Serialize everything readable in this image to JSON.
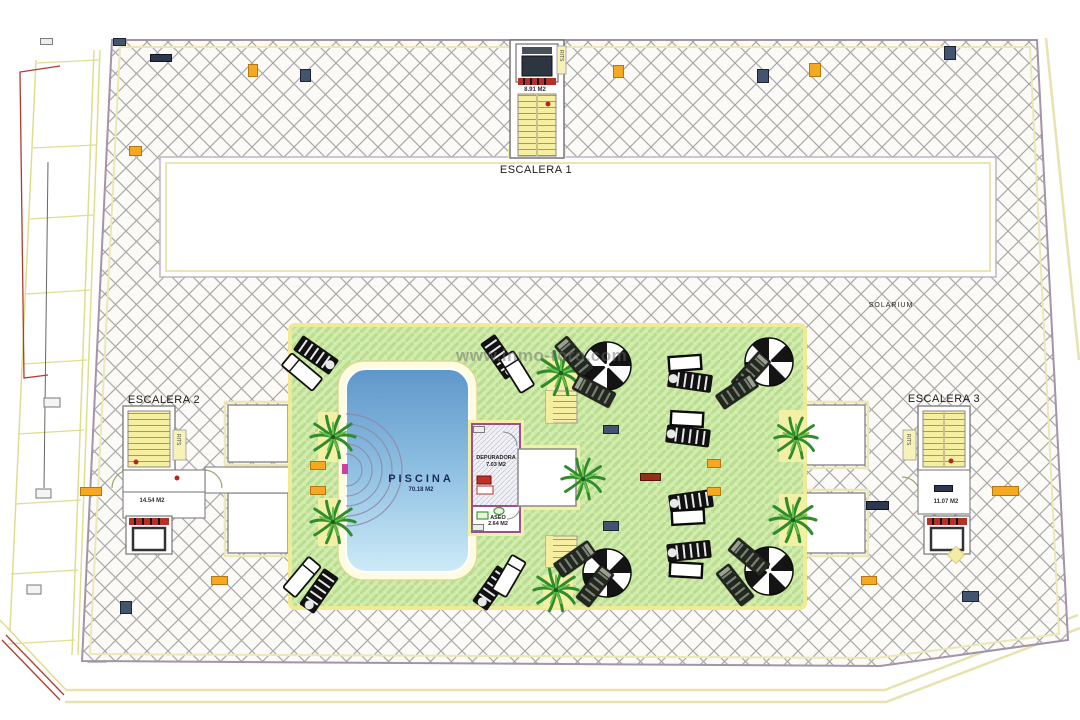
{
  "watermark": "www.inmo-toro.com",
  "labels": {
    "escalera1": "ESCALERA 1",
    "escalera2": "ESCALERA 2",
    "escalera3": "ESCALERA 3",
    "solarium": "SOLARIUM",
    "piscina": "PISCINA",
    "piscina_area": "70.18 M2",
    "esc1_area": "8.91 M2",
    "esc2_area": "14.54 M2",
    "esc3_area": "11.07 M2",
    "depuradora": "DEPURADORA",
    "depuradora_area": "7.03 M2",
    "aseo": "ASEO",
    "aseo_area": "2.64 M2",
    "rits": "RITS"
  },
  "colors": {
    "hatch_line": "#a9a9a9",
    "plan_border": "#a593a8",
    "site_yellow": "#e7e2ae",
    "deck_green": "#d3ecae",
    "deck_stripe": "#b9de92",
    "deck_border": "#f0ea94",
    "stairs_yellow": "#f6efa2",
    "pool_top": "#5f97cb",
    "pool_bottom": "#cdebf7",
    "wall_purple": "#9c4f8e",
    "accent_red": "#b5291d",
    "tag_orange": "#f6a820",
    "tag_navy": "#44536e",
    "magenta_marker": "#cc3fa0"
  },
  "tags": [
    {
      "x": 40,
      "y": 38,
      "w": 13,
      "h": 7,
      "v": "gray"
    },
    {
      "x": 113,
      "y": 38,
      "w": 13,
      "h": 8,
      "v": "navy"
    },
    {
      "x": 150,
      "y": 54,
      "w": 22,
      "h": 8,
      "v": "darknavy"
    },
    {
      "x": 248,
      "y": 64,
      "w": 10,
      "h": 13,
      "v": "orange"
    },
    {
      "x": 300,
      "y": 69,
      "w": 11,
      "h": 13,
      "v": "navy"
    },
    {
      "x": 129,
      "y": 146,
      "w": 13,
      "h": 10,
      "v": "orange"
    },
    {
      "x": 613,
      "y": 65,
      "w": 11,
      "h": 13,
      "v": "orange"
    },
    {
      "x": 757,
      "y": 69,
      "w": 12,
      "h": 14,
      "v": "navy"
    },
    {
      "x": 809,
      "y": 63,
      "w": 12,
      "h": 14,
      "v": "orange"
    },
    {
      "x": 944,
      "y": 46,
      "w": 12,
      "h": 14,
      "v": "navy"
    },
    {
      "x": 603,
      "y": 425,
      "w": 16,
      "h": 9,
      "v": "navy"
    },
    {
      "x": 640,
      "y": 473,
      "w": 21,
      "h": 8,
      "v": "maroon"
    },
    {
      "x": 707,
      "y": 459,
      "w": 14,
      "h": 9,
      "v": "orange"
    },
    {
      "x": 707,
      "y": 487,
      "w": 14,
      "h": 9,
      "v": "orange"
    },
    {
      "x": 603,
      "y": 521,
      "w": 16,
      "h": 10,
      "v": "navy"
    },
    {
      "x": 310,
      "y": 461,
      "w": 16,
      "h": 9,
      "v": "orange"
    },
    {
      "x": 310,
      "y": 486,
      "w": 16,
      "h": 9,
      "v": "orange"
    },
    {
      "x": 80,
      "y": 487,
      "w": 22,
      "h": 9,
      "v": "orange"
    },
    {
      "x": 211,
      "y": 576,
      "w": 17,
      "h": 9,
      "v": "orange"
    },
    {
      "x": 120,
      "y": 601,
      "w": 12,
      "h": 13,
      "v": "navy"
    },
    {
      "x": 866,
      "y": 501,
      "w": 23,
      "h": 9,
      "v": "darknavy"
    },
    {
      "x": 861,
      "y": 576,
      "w": 16,
      "h": 9,
      "v": "orange"
    },
    {
      "x": 962,
      "y": 591,
      "w": 17,
      "h": 11,
      "v": "navy"
    },
    {
      "x": 992,
      "y": 486,
      "w": 27,
      "h": 10,
      "v": "orange"
    },
    {
      "x": 934,
      "y": 485,
      "w": 19,
      "h": 7,
      "v": "darknavy"
    },
    {
      "x": 473,
      "y": 426,
      "w": 12,
      "h": 7,
      "v": "gray"
    },
    {
      "x": 472,
      "y": 524,
      "w": 12,
      "h": 7,
      "v": "gray"
    }
  ],
  "furniture": [
    {
      "k": "palm",
      "x": 333,
      "y": 437,
      "s": 1.3
    },
    {
      "k": "palm",
      "x": 333,
      "y": 522,
      "s": 1.3
    },
    {
      "k": "palm",
      "x": 561,
      "y": 373,
      "s": 1.35
    },
    {
      "k": "palm",
      "x": 583,
      "y": 479,
      "s": 1.25
    },
    {
      "k": "palm",
      "x": 556,
      "y": 590,
      "s": 1.3
    },
    {
      "k": "palm",
      "x": 796,
      "y": 438,
      "s": 1.25
    },
    {
      "k": "palm",
      "x": 793,
      "y": 520,
      "s": 1.35
    },
    {
      "k": "umb",
      "x": 607,
      "y": 366
    },
    {
      "k": "umb",
      "x": 769,
      "y": 362
    },
    {
      "k": "umb",
      "x": 607,
      "y": 573
    },
    {
      "k": "umb",
      "x": 769,
      "y": 571
    },
    {
      "k": "ld",
      "x": 574,
      "y": 357,
      "r": -40
    },
    {
      "k": "ld",
      "x": 594,
      "y": 391,
      "r": -62
    },
    {
      "k": "ld",
      "x": 751,
      "y": 372,
      "r": 42
    },
    {
      "k": "ld",
      "x": 737,
      "y": 391,
      "r": 56
    },
    {
      "k": "ld",
      "x": 575,
      "y": 559,
      "r": 55
    },
    {
      "k": "ld",
      "x": 595,
      "y": 586,
      "r": 38
    },
    {
      "k": "ld",
      "x": 749,
      "y": 557,
      "r": -50
    },
    {
      "k": "ld",
      "x": 735,
      "y": 585,
      "r": -38
    },
    {
      "k": "ls",
      "x": 316,
      "y": 355,
      "r": -55
    },
    {
      "k": "ls",
      "x": 500,
      "y": 357,
      "r": -35
    },
    {
      "k": "ls",
      "x": 319,
      "y": 591,
      "r": 35
    },
    {
      "k": "ls",
      "x": 492,
      "y": 588,
      "r": 35
    },
    {
      "k": "lw",
      "x": 302,
      "y": 372,
      "r": -50
    },
    {
      "k": "lw",
      "x": 517,
      "y": 372,
      "r": -32
    },
    {
      "k": "lw",
      "x": 302,
      "y": 577,
      "r": 40
    },
    {
      "k": "lw",
      "x": 509,
      "y": 576,
      "r": 30
    },
    {
      "k": "ls",
      "x": 690,
      "y": 381,
      "r": 98
    },
    {
      "k": "ls",
      "x": 688,
      "y": 436,
      "r": 97
    },
    {
      "k": "ls",
      "x": 691,
      "y": 501,
      "r": 82
    },
    {
      "k": "ls",
      "x": 689,
      "y": 551,
      "r": 84
    },
    {
      "k": "tb",
      "x": 685,
      "y": 363,
      "r": -4
    },
    {
      "k": "tb",
      "x": 687,
      "y": 419,
      "r": 3
    },
    {
      "k": "tb",
      "x": 688,
      "y": 517,
      "r": -3
    },
    {
      "k": "tb",
      "x": 686,
      "y": 570,
      "r": 3
    }
  ]
}
